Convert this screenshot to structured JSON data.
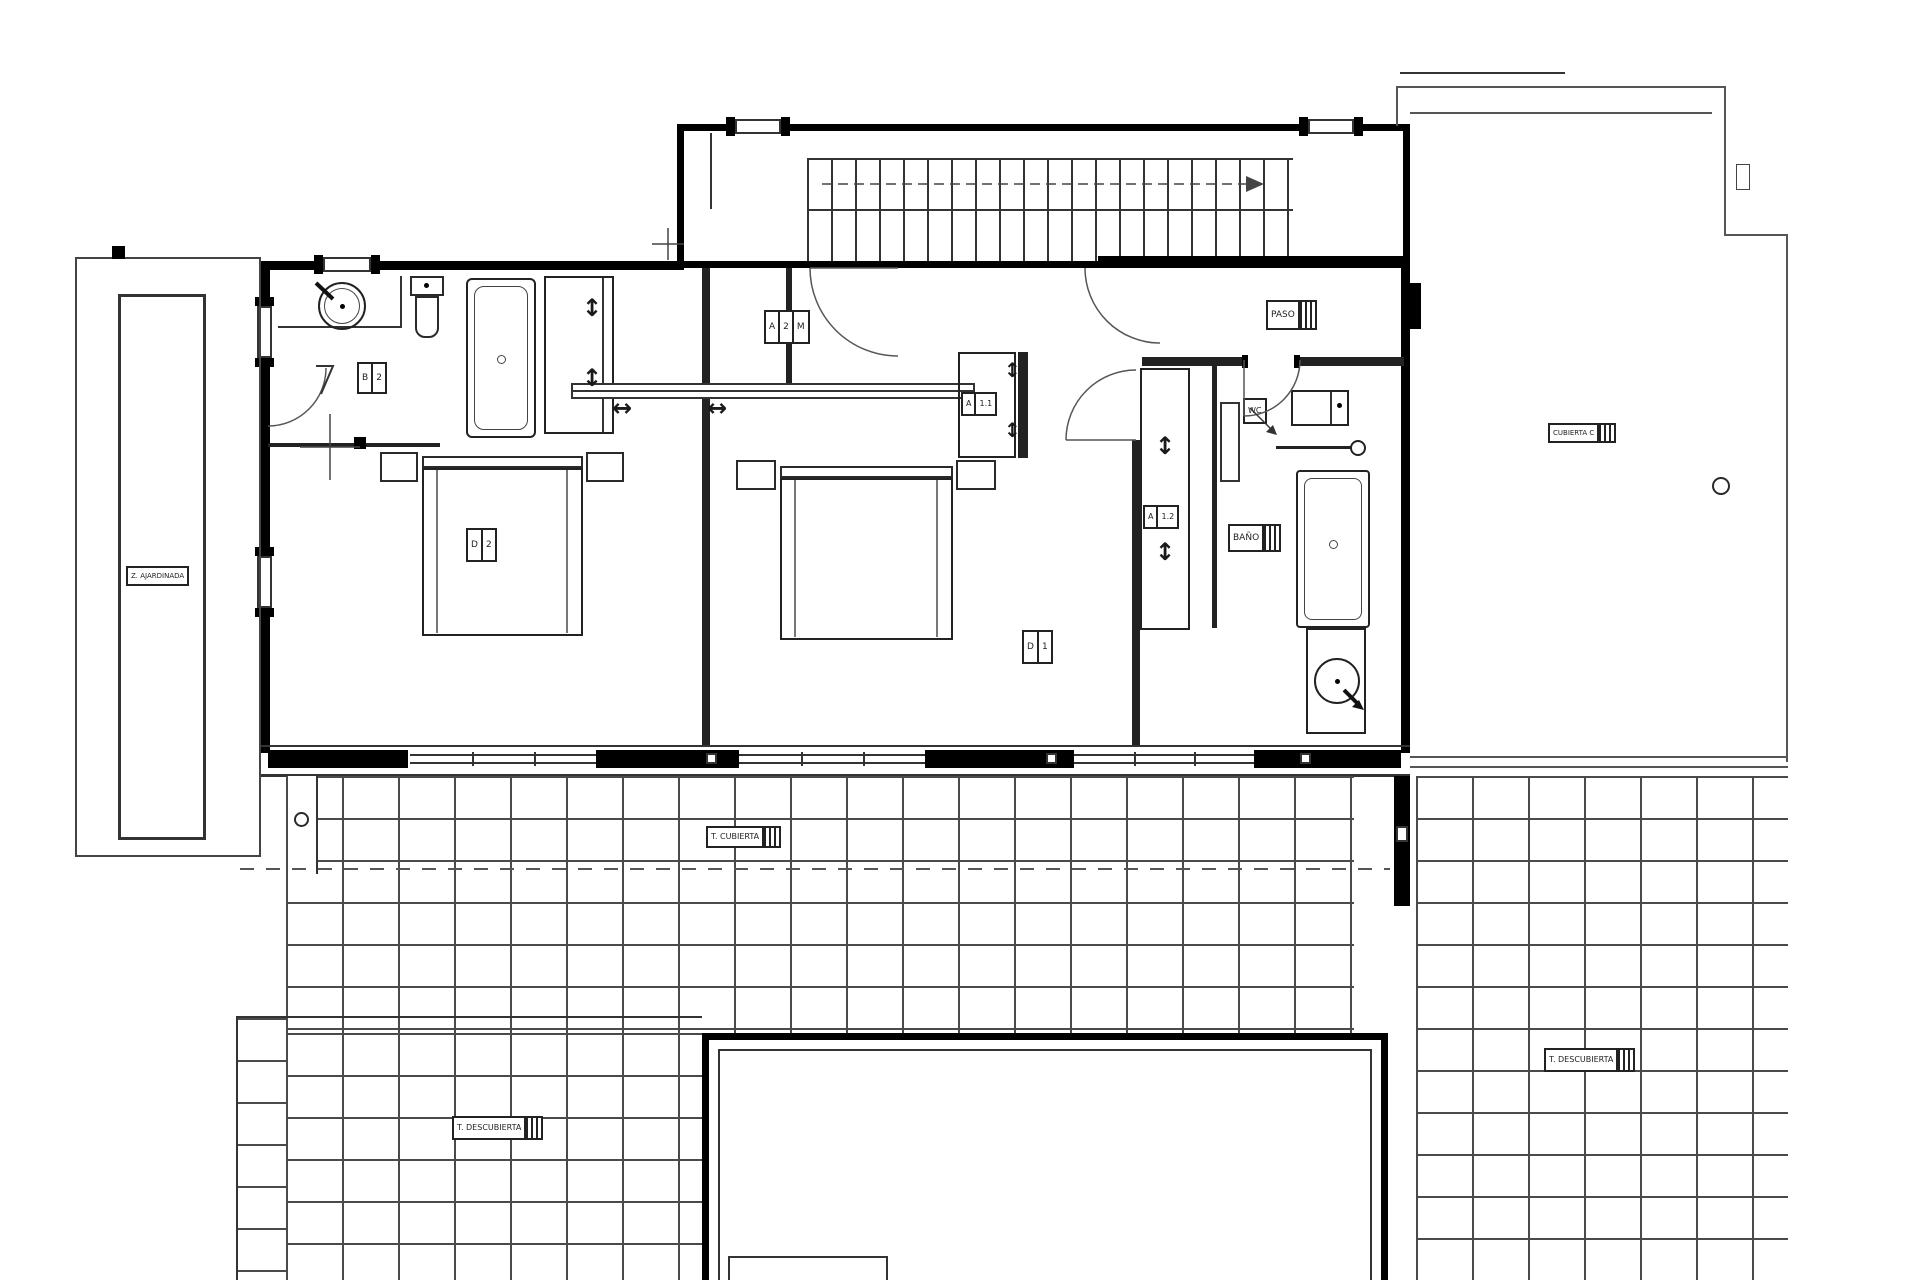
{
  "meta": {
    "type": "architectural floor plan",
    "floor": "upper floor of villa"
  },
  "colors": {
    "wall": "#000000",
    "line": "#333333",
    "tile_line": "#4a4a4a",
    "background": "#ffffff"
  },
  "labels": {
    "hall_code": {
      "c1": "A",
      "c2": "2",
      "c3": "M"
    },
    "paso": {
      "name": "PASO"
    },
    "bedroom1": {
      "code": "D",
      "num": "1"
    },
    "bedroom2": {
      "code": "D",
      "num": "2"
    },
    "bathroom2": {
      "code": "B",
      "num": "2"
    },
    "bath": {
      "name": "BAÑO"
    },
    "wc": {
      "name": "WC"
    },
    "closet11": {
      "code": "A",
      "num": "1.1"
    },
    "closet12": {
      "code": "A",
      "num": "1.2"
    },
    "garden": {
      "name": "Z. AJARDINADA"
    },
    "roof_c": {
      "name": "CUBIERTA C"
    },
    "terrace_covered": {
      "name": "T. CUBIERTA"
    },
    "terrace_open_left": {
      "name": "T. DESCUBIERTA"
    },
    "terrace_open_right": {
      "name": "T. DESCUBIERTA"
    }
  },
  "symbols": {
    "updown_arrow": "↕",
    "leftright_arrow": "↔"
  }
}
